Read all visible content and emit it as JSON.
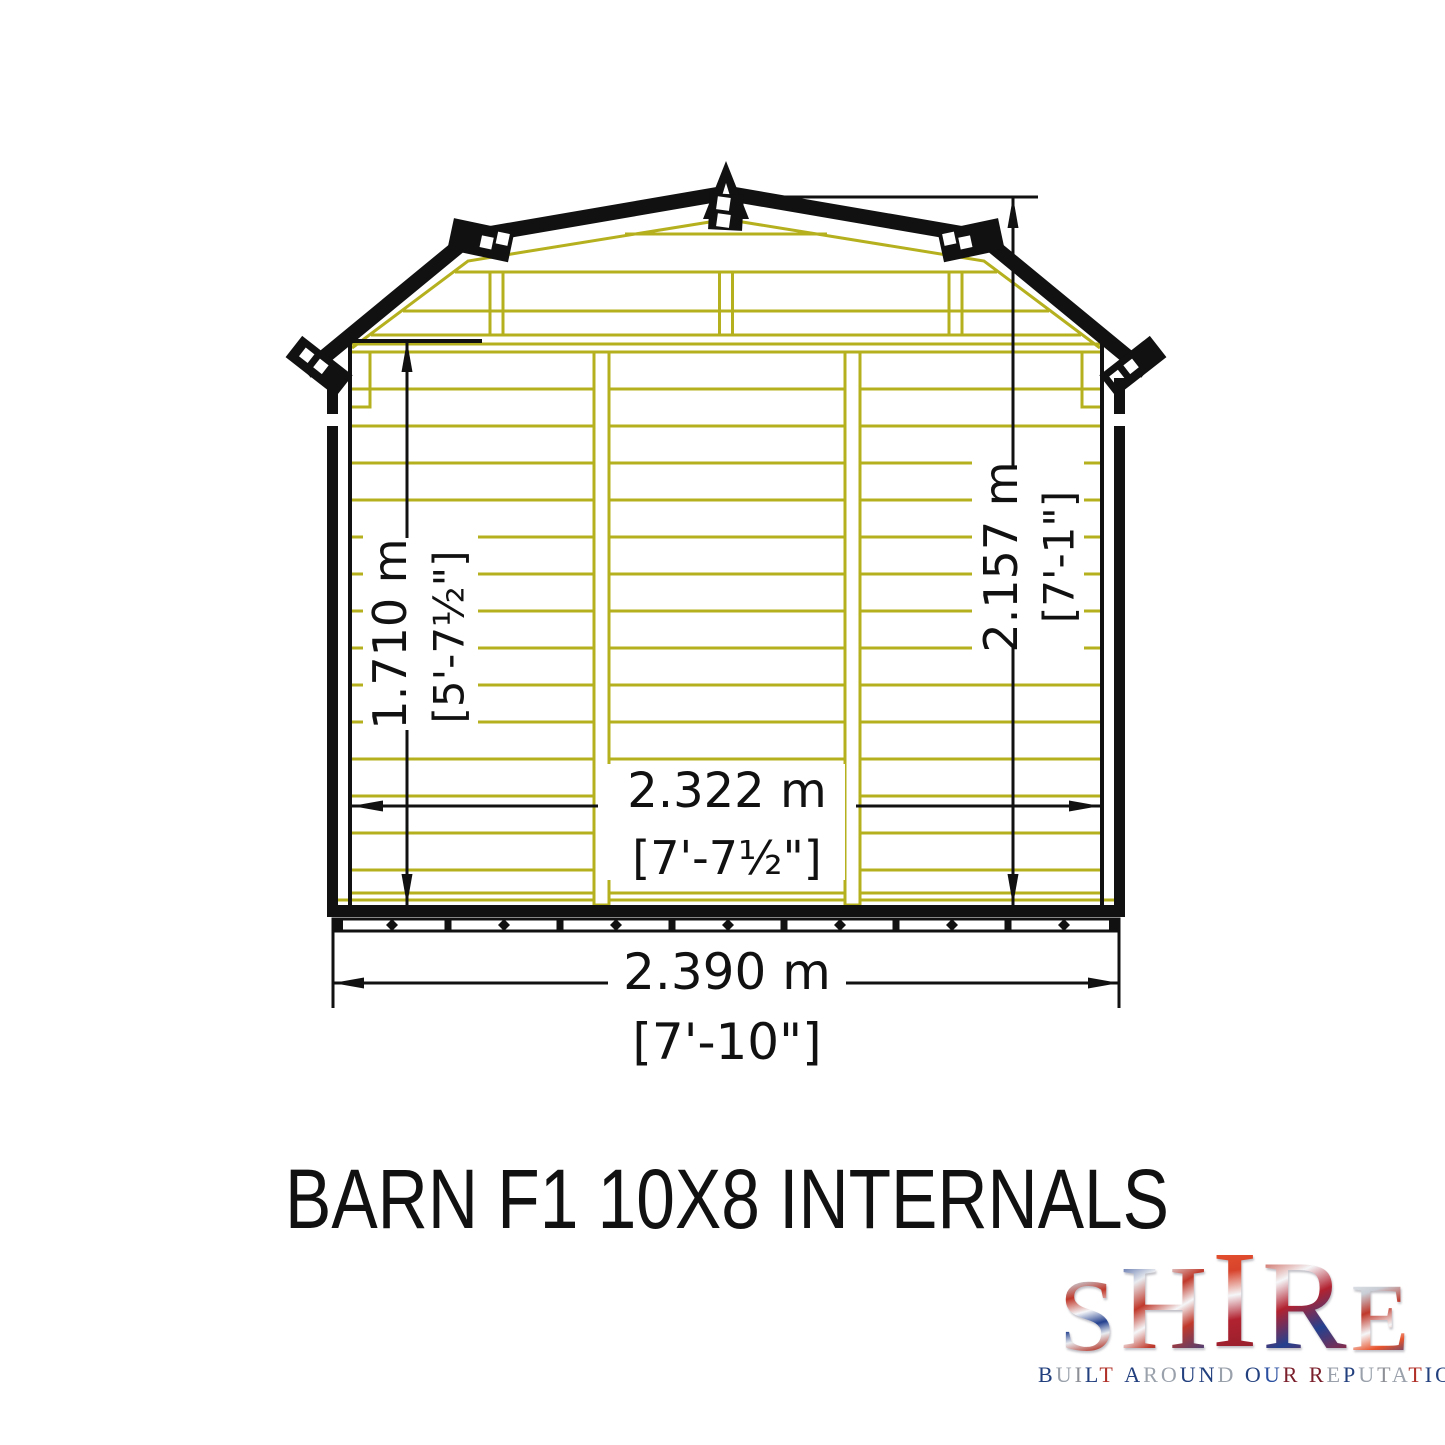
{
  "diagram": {
    "title": "BARN F1 10X8 INTERNALS",
    "dims": {
      "wall_height_m": "1.710 m",
      "wall_height_ft": "[5'-7½\"]",
      "ridge_height_m": "2.157 m",
      "ridge_height_ft": "[7'-1\"]",
      "internal_width_m": "2.322 m",
      "internal_width_ft": "[7'-7½\"]",
      "external_width_m": "2.390 m",
      "external_width_ft": "[7'-10\"]"
    },
    "colors": {
      "outline": "#111111",
      "timber": "#b5b01e",
      "dimension": "#111111"
    }
  },
  "brand": {
    "name": "SHIRE",
    "tagline": "BUILT AROUND OUR REPUTATION",
    "tagline_letter_colors": [
      "#23407e",
      "#9aa1ab",
      "#8c8f96",
      "#23407e",
      "#b03028",
      "#23407e",
      "#9aa1ab",
      "#9aa1ab",
      "#23407e",
      "#23407e",
      "#9aa1ab",
      "#23407e",
      "#2a4fa0",
      "#7a1f2b",
      "#7a1f2b",
      "#9aa1ab",
      "#23407e",
      "#9aa1ab",
      "#8c8f96",
      "#9aa1ab",
      "#b03028",
      "#23407e",
      "#23407e",
      "#b03028"
    ],
    "flag": {
      "red": "#c0392b",
      "blue": "#24418f",
      "white": "#f2f4f7"
    }
  }
}
